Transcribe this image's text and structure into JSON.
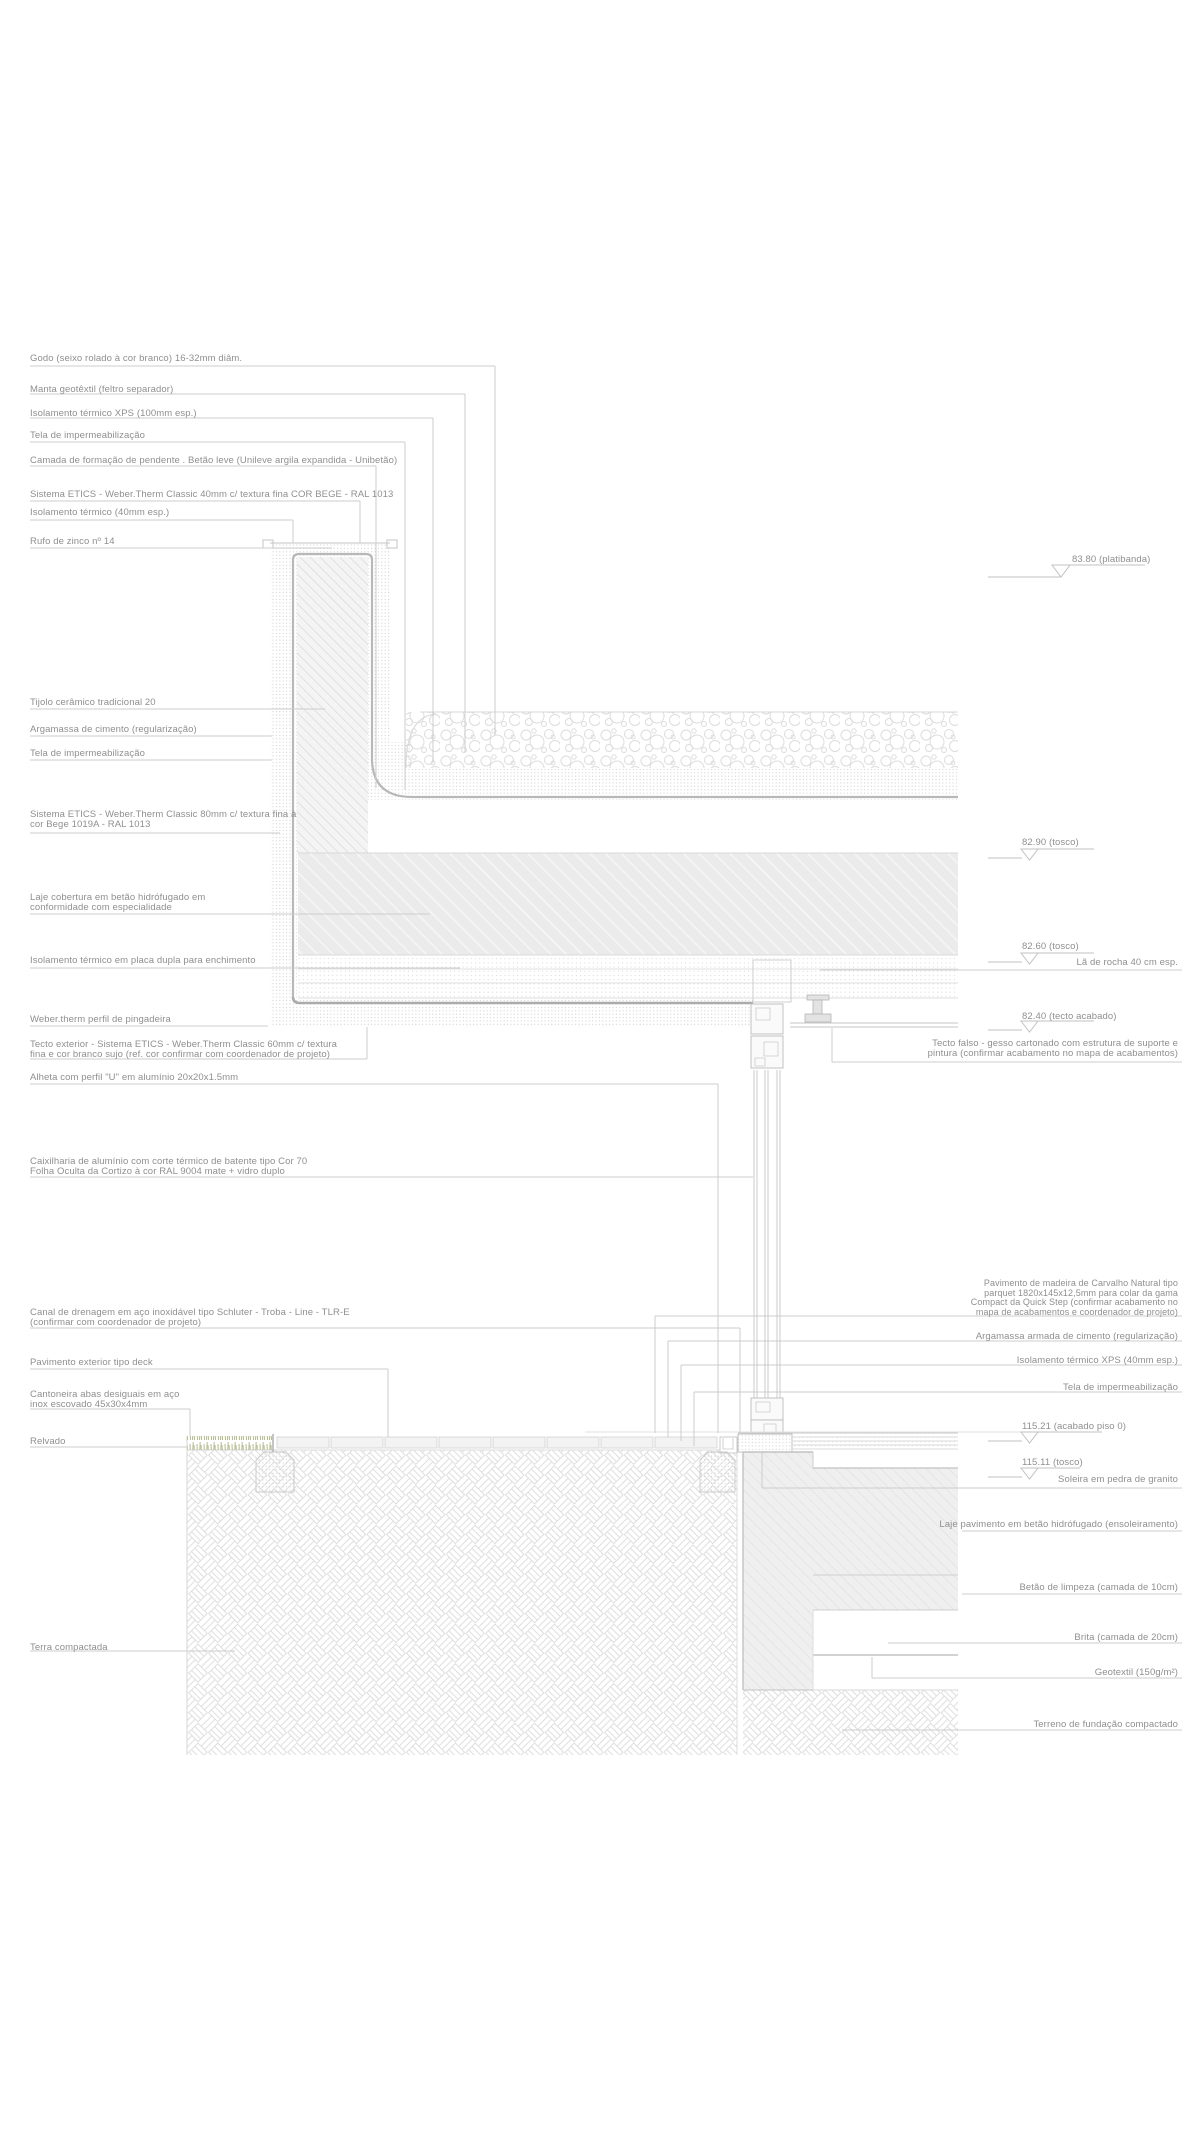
{
  "drawing": {
    "type": "architectural-construction-detail-section",
    "language": "pt",
    "colors": {
      "background": "#ffffff",
      "leader_line": "#cccccc",
      "label_text": "#8f8f8f",
      "hatch_light": "#dddddd",
      "concrete_fill": "#ececec",
      "grass_green": "#b3bb8e"
    }
  },
  "annotations": {
    "left": [
      "Godo (seixo rolado à cor branco) 16-32mm diâm.",
      "Manta geotêxtil (feltro separador)",
      "Isolamento térmico XPS (100mm esp.)",
      "Tela de impermeabilização",
      "Camada de formação de pendente . Betão leve (Unileve argila expandida - Unibetão)",
      "Sistema ETICS - Weber.Therm Classic 40mm c/ textura fina COR BEGE - RAL 1013",
      "Isolamento térmico (40mm esp.)",
      "Rufo de zinco nº 14",
      "Tijolo cerâmico tradicional 20",
      "Argamassa de cimento (regularização)",
      "Tela de impermeabilização",
      "Sistema ETICS - Weber.Therm Classic 80mm c/ textura fina à\ncor Bege 1019A - RAL 1013",
      "Laje cobertura em betão hidrófugado em\nconformidade com especialidade",
      "Isolamento térmico em placa dupla para enchimento",
      "Weber.therm perfil de pingadeira",
      "Tecto exterior - Sistema ETICS - Weber.Therm Classic 60mm c/ textura\nfina e cor branco sujo (ref. cor confirmar com coordenador de projeto)",
      "Alheta com perfil \"U\" em alumínio 20x20x1.5mm",
      "Caixilharia de alumínio com corte térmico de batente tipo Cor 70\nFolha Oculta da Cortizo à cor RAL 9004 mate + vidro duplo",
      "Canal de drenagem em aço inoxidável tipo Schluter - Troba - Line - TLR-E\n(confirmar com coordenador de projeto)",
      "Pavimento exterior tipo deck",
      "Cantoneira abas desiguais em aço\ninox escovado 45x30x4mm",
      "Relvado",
      "Terra compactada"
    ],
    "right": [
      "83.80 (platibanda)",
      "82.90 (tosco)",
      "82.60 (tosco)",
      "Lã de rocha 40 cm esp.",
      "82.40 (tecto acabado)",
      "Tecto falso - gesso cartonado com estrutura de suporte e\npintura (confirmar acabamento no mapa de acabamentos)",
      "Pavimento de madeira de Carvalho Natural tipo\nparquet 1820x145x12,5mm para colar da gama\nCompact da Quick Step (confirmar acabamento no\nmapa de acabamentos e coordenador de projeto)",
      "Argamassa armada de cimento (regularização)",
      "Isolamento térmico XPS (40mm esp.)",
      "Tela de impermeabilização",
      "115.21 (acabado piso 0)",
      "115.11 (tosco)",
      "Soleira em pedra de granito",
      "Laje pavimento em betão hidrófugado (ensoleiramento)",
      "Betão de limpeza (camada de 10cm)",
      "Brita (camada de 20cm)",
      "Geotextil (150g/m²)",
      "Terreno de fundação compactado"
    ],
    "level_values": [
      "83.80",
      "82.90",
      "82.60",
      "82.40",
      "115.21",
      "115.11"
    ]
  }
}
